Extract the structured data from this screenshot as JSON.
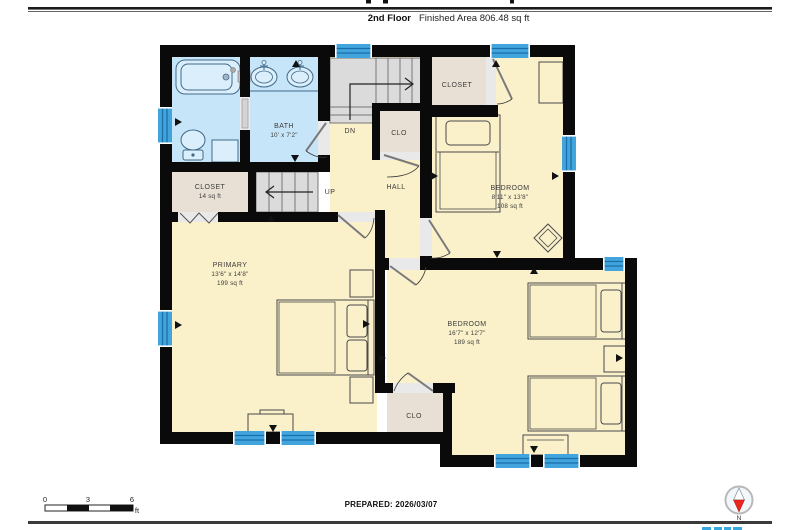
{
  "header": {
    "floor_label": "2nd Floor",
    "area_label": "Finished Area 806.48 sq ft"
  },
  "plan": {
    "rooms": {
      "bath": {
        "name": "BATH",
        "dims": "10' x 7'2\""
      },
      "closet_left": {
        "name": "CLOSET",
        "area": "14 sq ft"
      },
      "closet_upper": {
        "label": "CLOSET"
      },
      "clo_mid": {
        "label": "CLO"
      },
      "clo_lower": {
        "label": "CLO"
      },
      "hall": {
        "label": "HALL"
      },
      "bedroom_upper": {
        "name": "BEDROOM",
        "dims": "8'11\" x 13'8\"",
        "area": "108 sq ft"
      },
      "primary": {
        "name": "PRIMARY",
        "dims": "13'6\" x 14'8\"",
        "area": "199 sq ft"
      },
      "bedroom_lower": {
        "name": "BEDROOM",
        "dims": "16'7\" x 12'7\"",
        "area": "189 sq ft"
      }
    },
    "stairs": {
      "up": "UP",
      "down": "DN"
    }
  },
  "footer": {
    "scale": {
      "ticks": [
        "0",
        "3",
        "6"
      ],
      "unit": "ft"
    },
    "prepared": "PREPARED: 2026/03/07",
    "compass_n": "N"
  },
  "colors": {
    "wall": "#0a0a0a",
    "floor_cream": "#faf0ca",
    "bath_blue": "#c6e5f8",
    "closet_tan": "#e8e0d4",
    "stair_gray": "#dbdbdb",
    "window_blue": "#42a4dc",
    "compass_red": "#e8281e",
    "logo_blue": "#35a8e0"
  }
}
